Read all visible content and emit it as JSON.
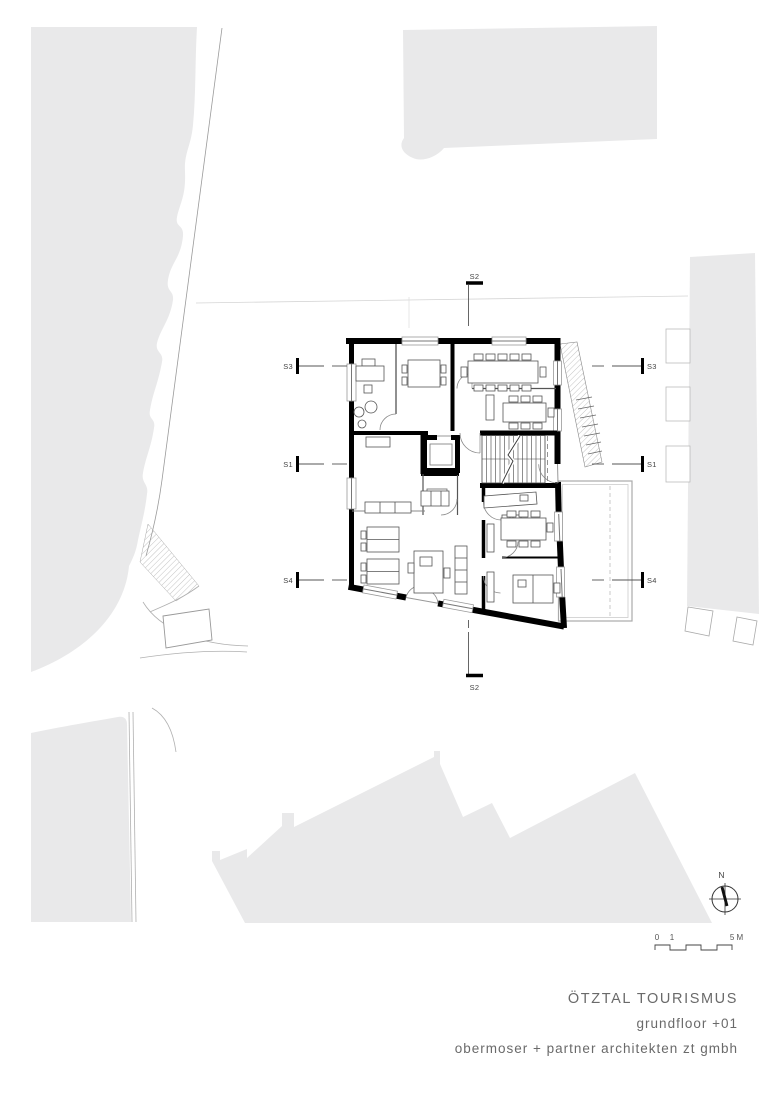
{
  "title_block": {
    "project": "ÖTZTAL TOURISMUS",
    "floor": "grundfloor +01",
    "firm": "obermoser + partner architekten zt gmbh"
  },
  "section_markers": {
    "s1": "S1",
    "s2": "S2",
    "s3": "S3",
    "s4": "S4"
  },
  "compass": {
    "north": "N"
  },
  "scale_bar": {
    "zero": "0",
    "one": "1",
    "five": "5 M"
  },
  "colors": {
    "site_fill": "#e9e9ea",
    "wall": "#000000",
    "thin_line": "#8a8a8a",
    "faint_line": "#d5d5d5",
    "text": "#6a6a6a"
  }
}
